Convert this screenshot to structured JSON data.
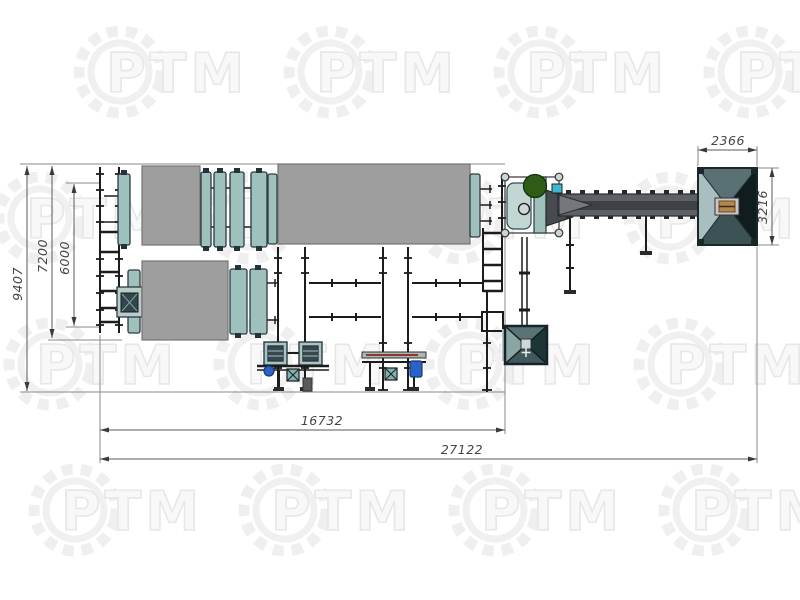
{
  "watermark": {
    "text": "РТМ"
  },
  "dimensions": {
    "total_length": "27122",
    "line_length": "16732",
    "overall_width": "9407",
    "drum_line_width": "7200",
    "feed_conveyor_length": "6000",
    "hopper_width": "2366",
    "hopper_depth": "3216"
  },
  "colors": {
    "steel_gray": "#9e9e9e",
    "ring_teal": "#9fc1bc",
    "panel_teal": "#c2d6d4",
    "motor_green": "#2e5c16",
    "motor_blue": "#2a63c8",
    "accent_cyan": "#3fb6cf",
    "conveyor_gray": "#5d6165",
    "conveyor_stripe": "#3e4246",
    "hopper_left": "#a9bebe",
    "hopper_top": "#5a7173",
    "hopper_right": "#111c1e",
    "hopper_bottom": "#3c5254",
    "small_hopper_left": "#8ba4a4",
    "small_hopper_top": "#5a7476",
    "small_hopper_right": "#1e3536",
    "small_hopper_bottom": "#42595b"
  }
}
